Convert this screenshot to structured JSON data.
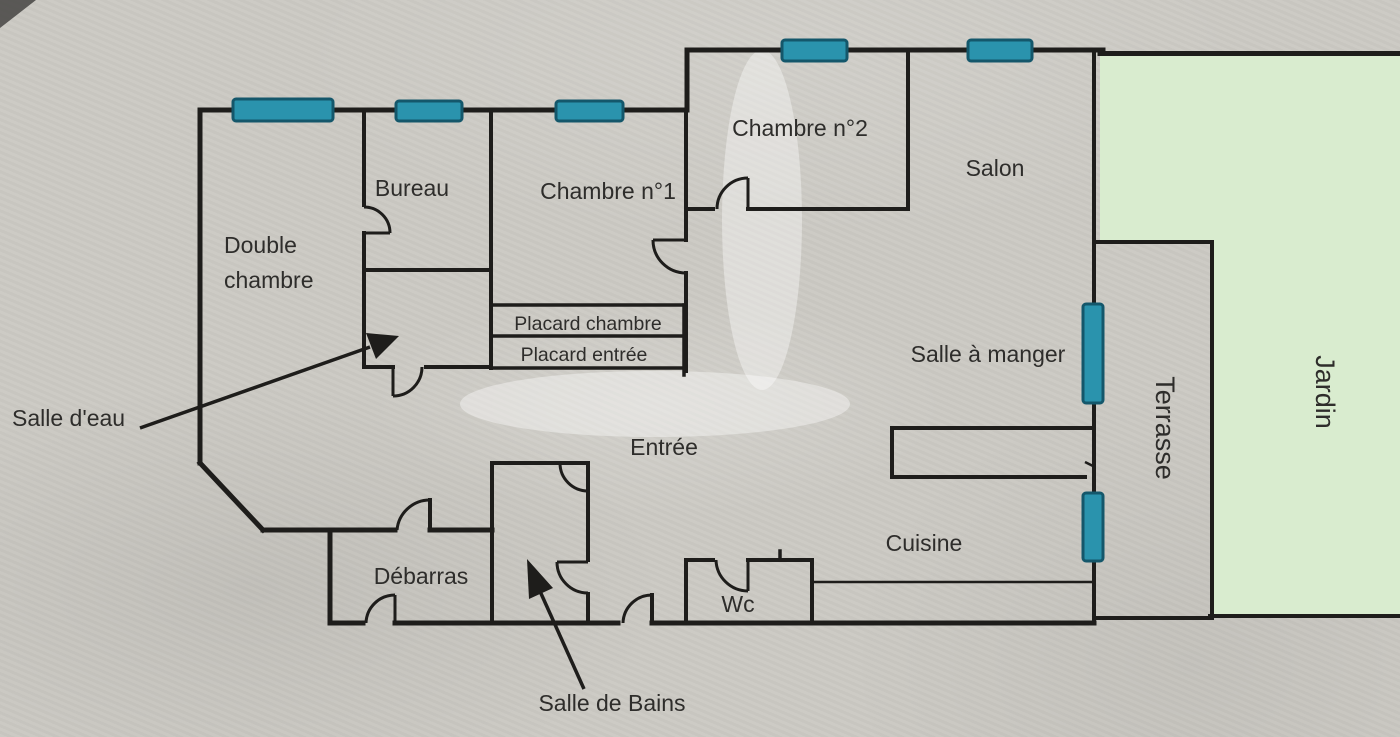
{
  "floorplan": {
    "rooms": {
      "double_chambre": {
        "line1": "Double",
        "line2": "chambre"
      },
      "bureau": {
        "label": "Bureau"
      },
      "chambre1": {
        "label": "Chambre n°1"
      },
      "chambre2": {
        "label": "Chambre n°2"
      },
      "salon": {
        "label": "Salon"
      },
      "placard_chambre": {
        "label": "Placard chambre"
      },
      "placard_entree": {
        "label": "Placard entrée"
      },
      "salle_a_manger": {
        "label": "Salle à manger"
      },
      "salle_deau": {
        "label": "Salle d'eau"
      },
      "entree": {
        "label": "Entrée"
      },
      "terrasse": {
        "label": "Terrasse"
      },
      "jardin": {
        "label": "Jardin"
      },
      "debarras": {
        "label": "Débarras"
      },
      "cuisine": {
        "label": "Cuisine"
      },
      "wc": {
        "label": "Wc"
      },
      "salle_de_bains": {
        "label": "Salle de Bains"
      }
    },
    "colors": {
      "paper": "#cccac4",
      "wall": "#1e1d1b",
      "text": "#2e2d2b",
      "window_fill": "#2a93ad",
      "window_border": "#14576b",
      "garden_fill": "#d9eccf"
    }
  }
}
